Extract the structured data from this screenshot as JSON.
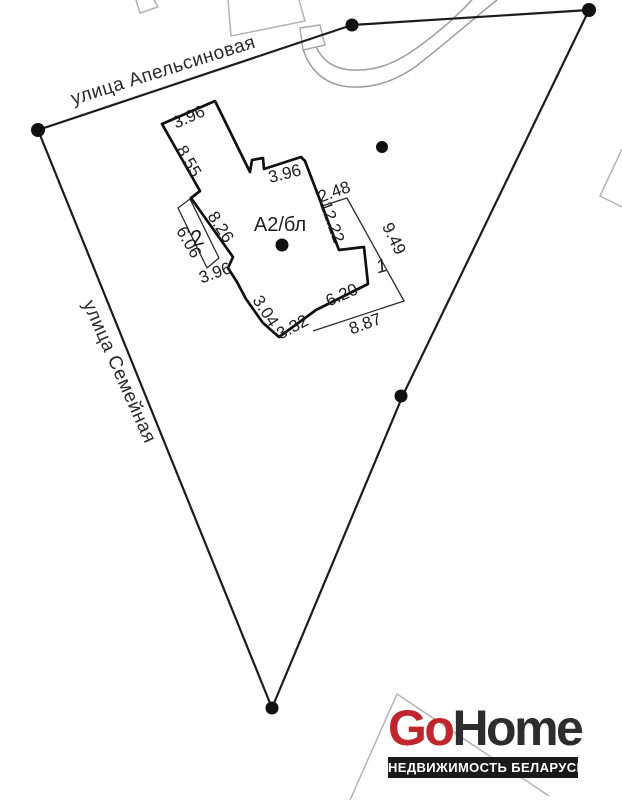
{
  "map": {
    "streets": {
      "top": "улица Апельсиновая",
      "left": "улица Семейная"
    },
    "building": {
      "label": "А2/бл"
    },
    "structures": {
      "annex1_label": "1",
      "annex2_label": "2"
    },
    "dimensions": {
      "top_left_edge": "3.96",
      "left_wall": "8.55",
      "mid_top_edge": "3.96",
      "right_top_edge": "2.48",
      "right_wall": "12.22",
      "annex1_right_edge": "9.49",
      "left_lower_wall": "8.26",
      "annex2_outer_edge": "6.06",
      "annex2_bottom_edge": "3.96",
      "bottom_diag_left": "3.04",
      "bottom_diag_right": "3.32",
      "bottom_wall": "6.20",
      "annex1_bottom_edge": "8.87"
    }
  },
  "logo": {
    "brand_red_part": "Go",
    "brand_dark_part": "Home",
    "tagline": "НЕДВИЖИМОСТЬ БЕЛАРУСИ",
    "colors": {
      "brand_red": "#c0262b",
      "brand_dark": "#2d2d2d",
      "tagline_bar_bg": "#1a1a1a",
      "tagline_text": "#ffffff"
    }
  }
}
